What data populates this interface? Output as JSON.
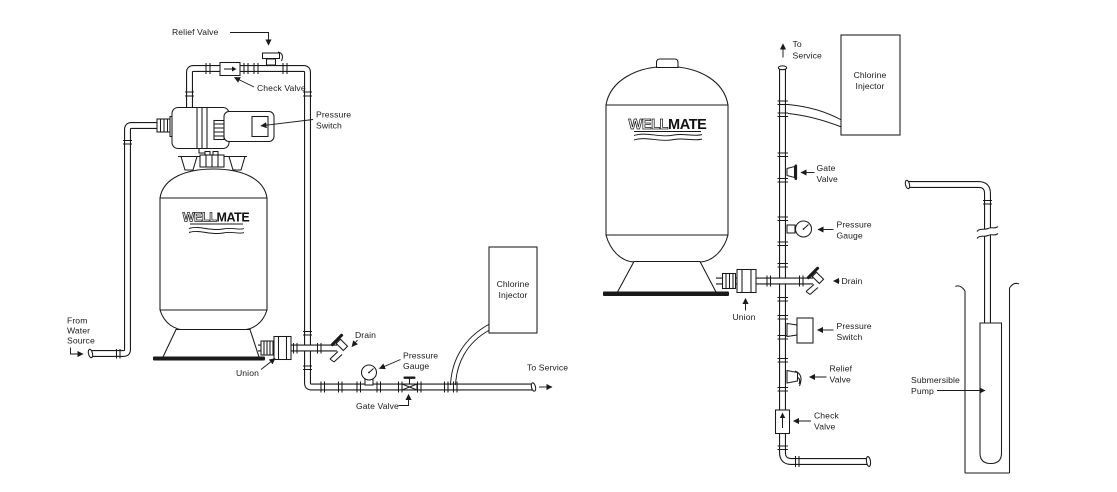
{
  "colors": {
    "ink": "#1a1a1a",
    "paper": "#ffffff"
  },
  "left_diagram": {
    "logo": {
      "well": "WELL",
      "mate": "MATE"
    },
    "labels": {
      "relief_valve": "Relief Valve",
      "check_valve": "Check Valve",
      "pressure_switch": [
        "Pressure",
        "Switch"
      ],
      "from_water_source": [
        "From",
        "Water",
        "Source"
      ],
      "union": "Union",
      "drain": "Drain",
      "pressure_gauge": [
        "Pressure",
        "Gauge"
      ],
      "gate_valve": "Gate Valve",
      "chlorine_injector": [
        "Chlorine",
        "Injector"
      ],
      "to_service": "To Service"
    }
  },
  "right_diagram": {
    "logo": {
      "well": "WELL",
      "mate": "MATE"
    },
    "labels": {
      "to_service": [
        "To",
        "Service"
      ],
      "chlorine_injector": [
        "Chlorine",
        "Injector"
      ],
      "gate_valve": [
        "Gate",
        "Valve"
      ],
      "pressure_gauge": [
        "Pressure",
        "Gauge"
      ],
      "drain": "Drain",
      "union": "Union",
      "pressure_switch": [
        "Pressure",
        "Switch"
      ],
      "relief_valve": [
        "Relief",
        "Valve"
      ],
      "check_valve": [
        "Check",
        "Valve"
      ],
      "submersible_pump": [
        "Submersible",
        "Pump"
      ]
    }
  }
}
